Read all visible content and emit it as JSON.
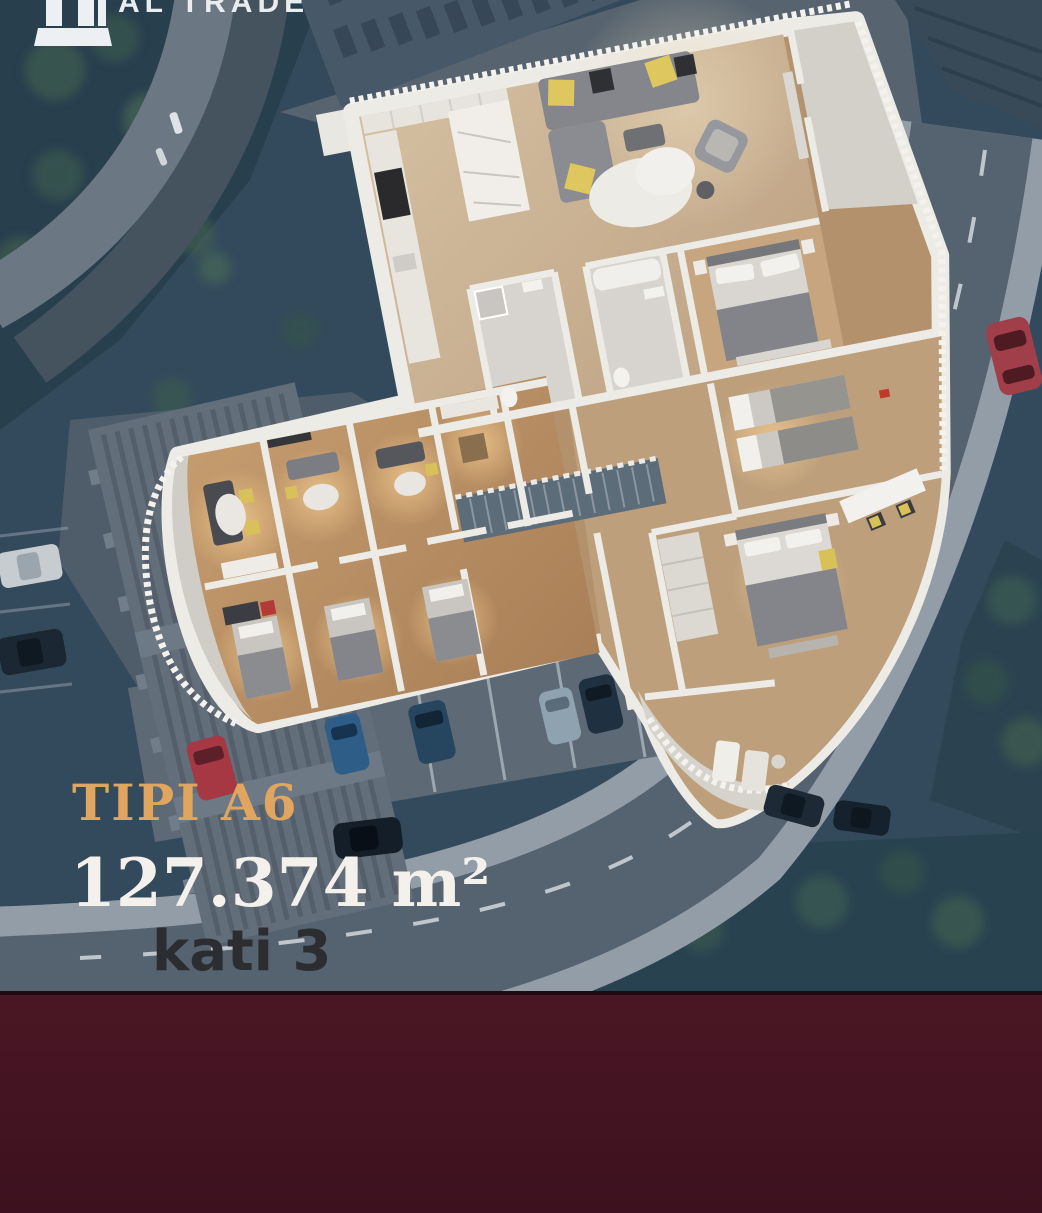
{
  "brand": {
    "name": "AL TRADE",
    "logo_icon": "building-columns-icon"
  },
  "overlay": {
    "type_label": "TIPI A6",
    "area_label": "127.374 m²",
    "floor_label": "kati 3"
  },
  "colors": {
    "type_gold": "#E0A55E",
    "area_white": "#F4F1EC",
    "floor_dark": "#2C2D31",
    "band_maroon": "#4A1624",
    "background_blue": "#334A5C",
    "road_gray": "#55626F",
    "plan_wall_white": "#EDEBE6",
    "plan_wood": "#CBB596"
  }
}
